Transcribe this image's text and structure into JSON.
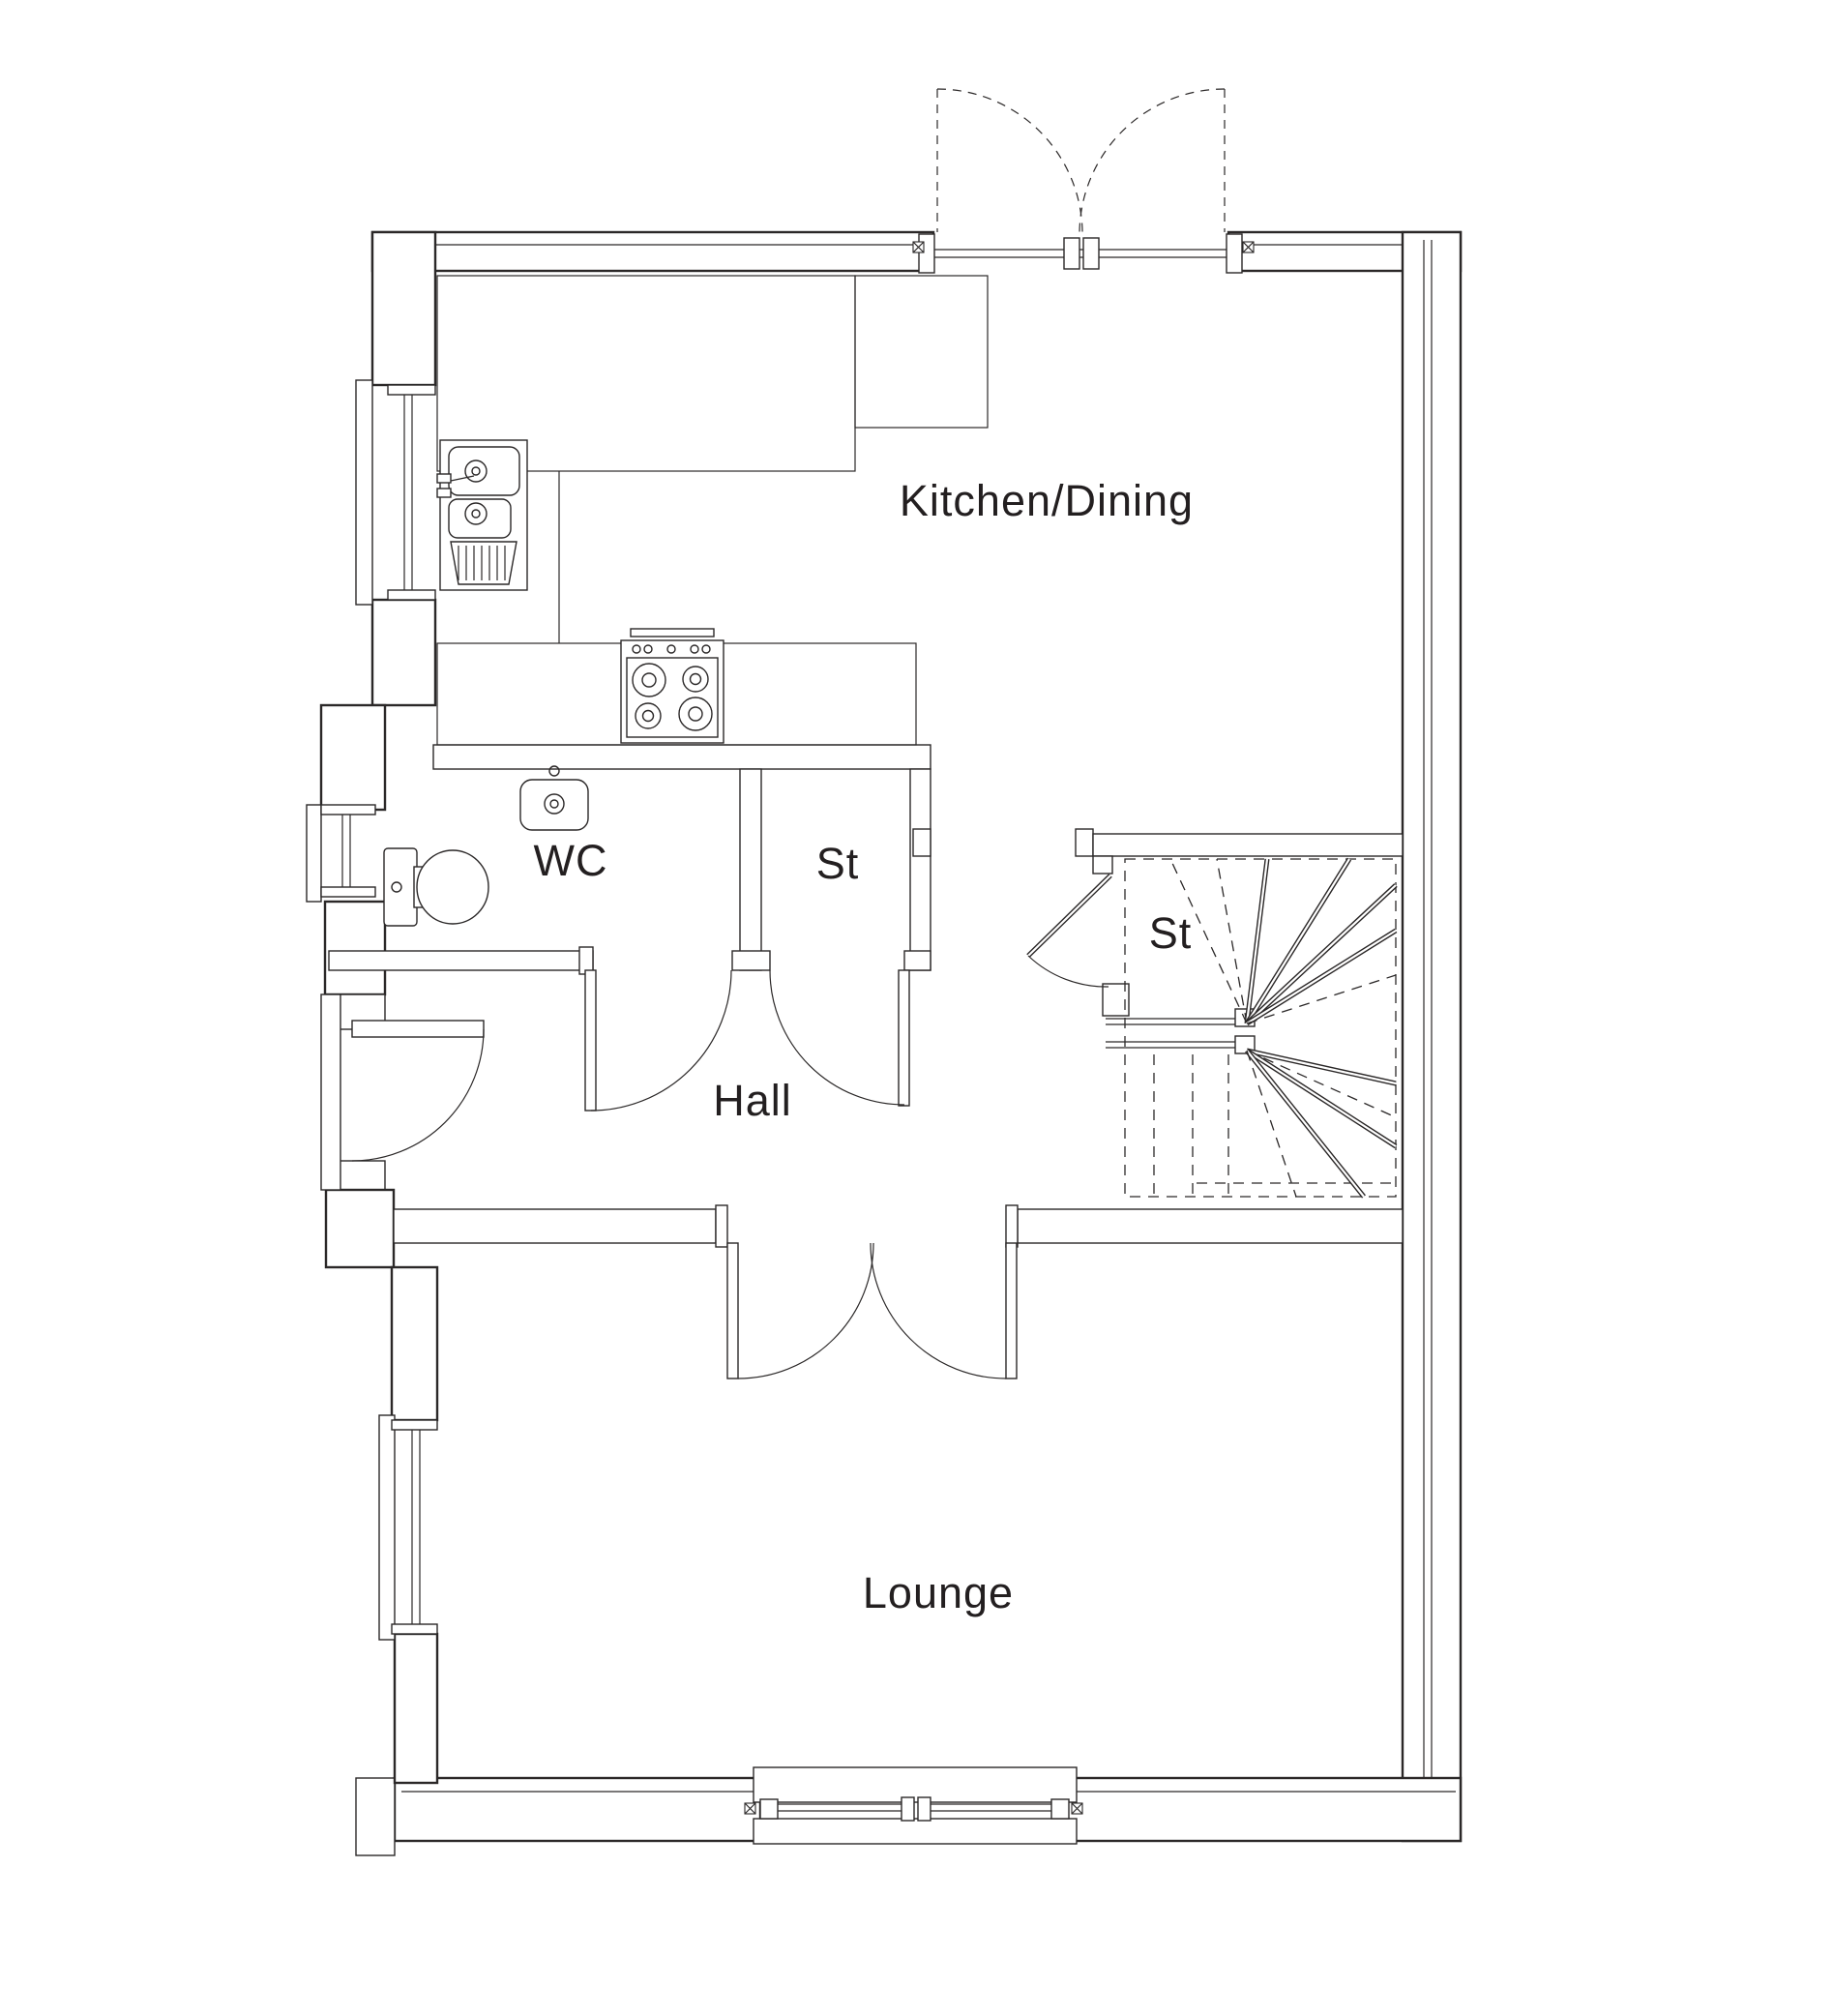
{
  "plan": {
    "background_color": "#ffffff",
    "line_color": "#2b2828",
    "text_color": "#231f20",
    "rooms": {
      "kitchen_dining": {
        "label": "Kitchen/Dining"
      },
      "wc": {
        "label": "WC"
      },
      "cupboard": {
        "label": "St"
      },
      "understairs": {
        "label": "St"
      },
      "hall": {
        "label": "Hall"
      },
      "lounge": {
        "label": "Lounge"
      }
    },
    "fixtures": {
      "sink": "kitchen-sink-with-drainer",
      "hob": "four-ring-hob",
      "basin": "wc-basin",
      "toilet": "wc-toilet",
      "stairs": "winder-staircase"
    },
    "features": {
      "french_doors": "double-french-doors-opening-out",
      "front_door": "front-entrance-door",
      "window_count": 5
    }
  }
}
